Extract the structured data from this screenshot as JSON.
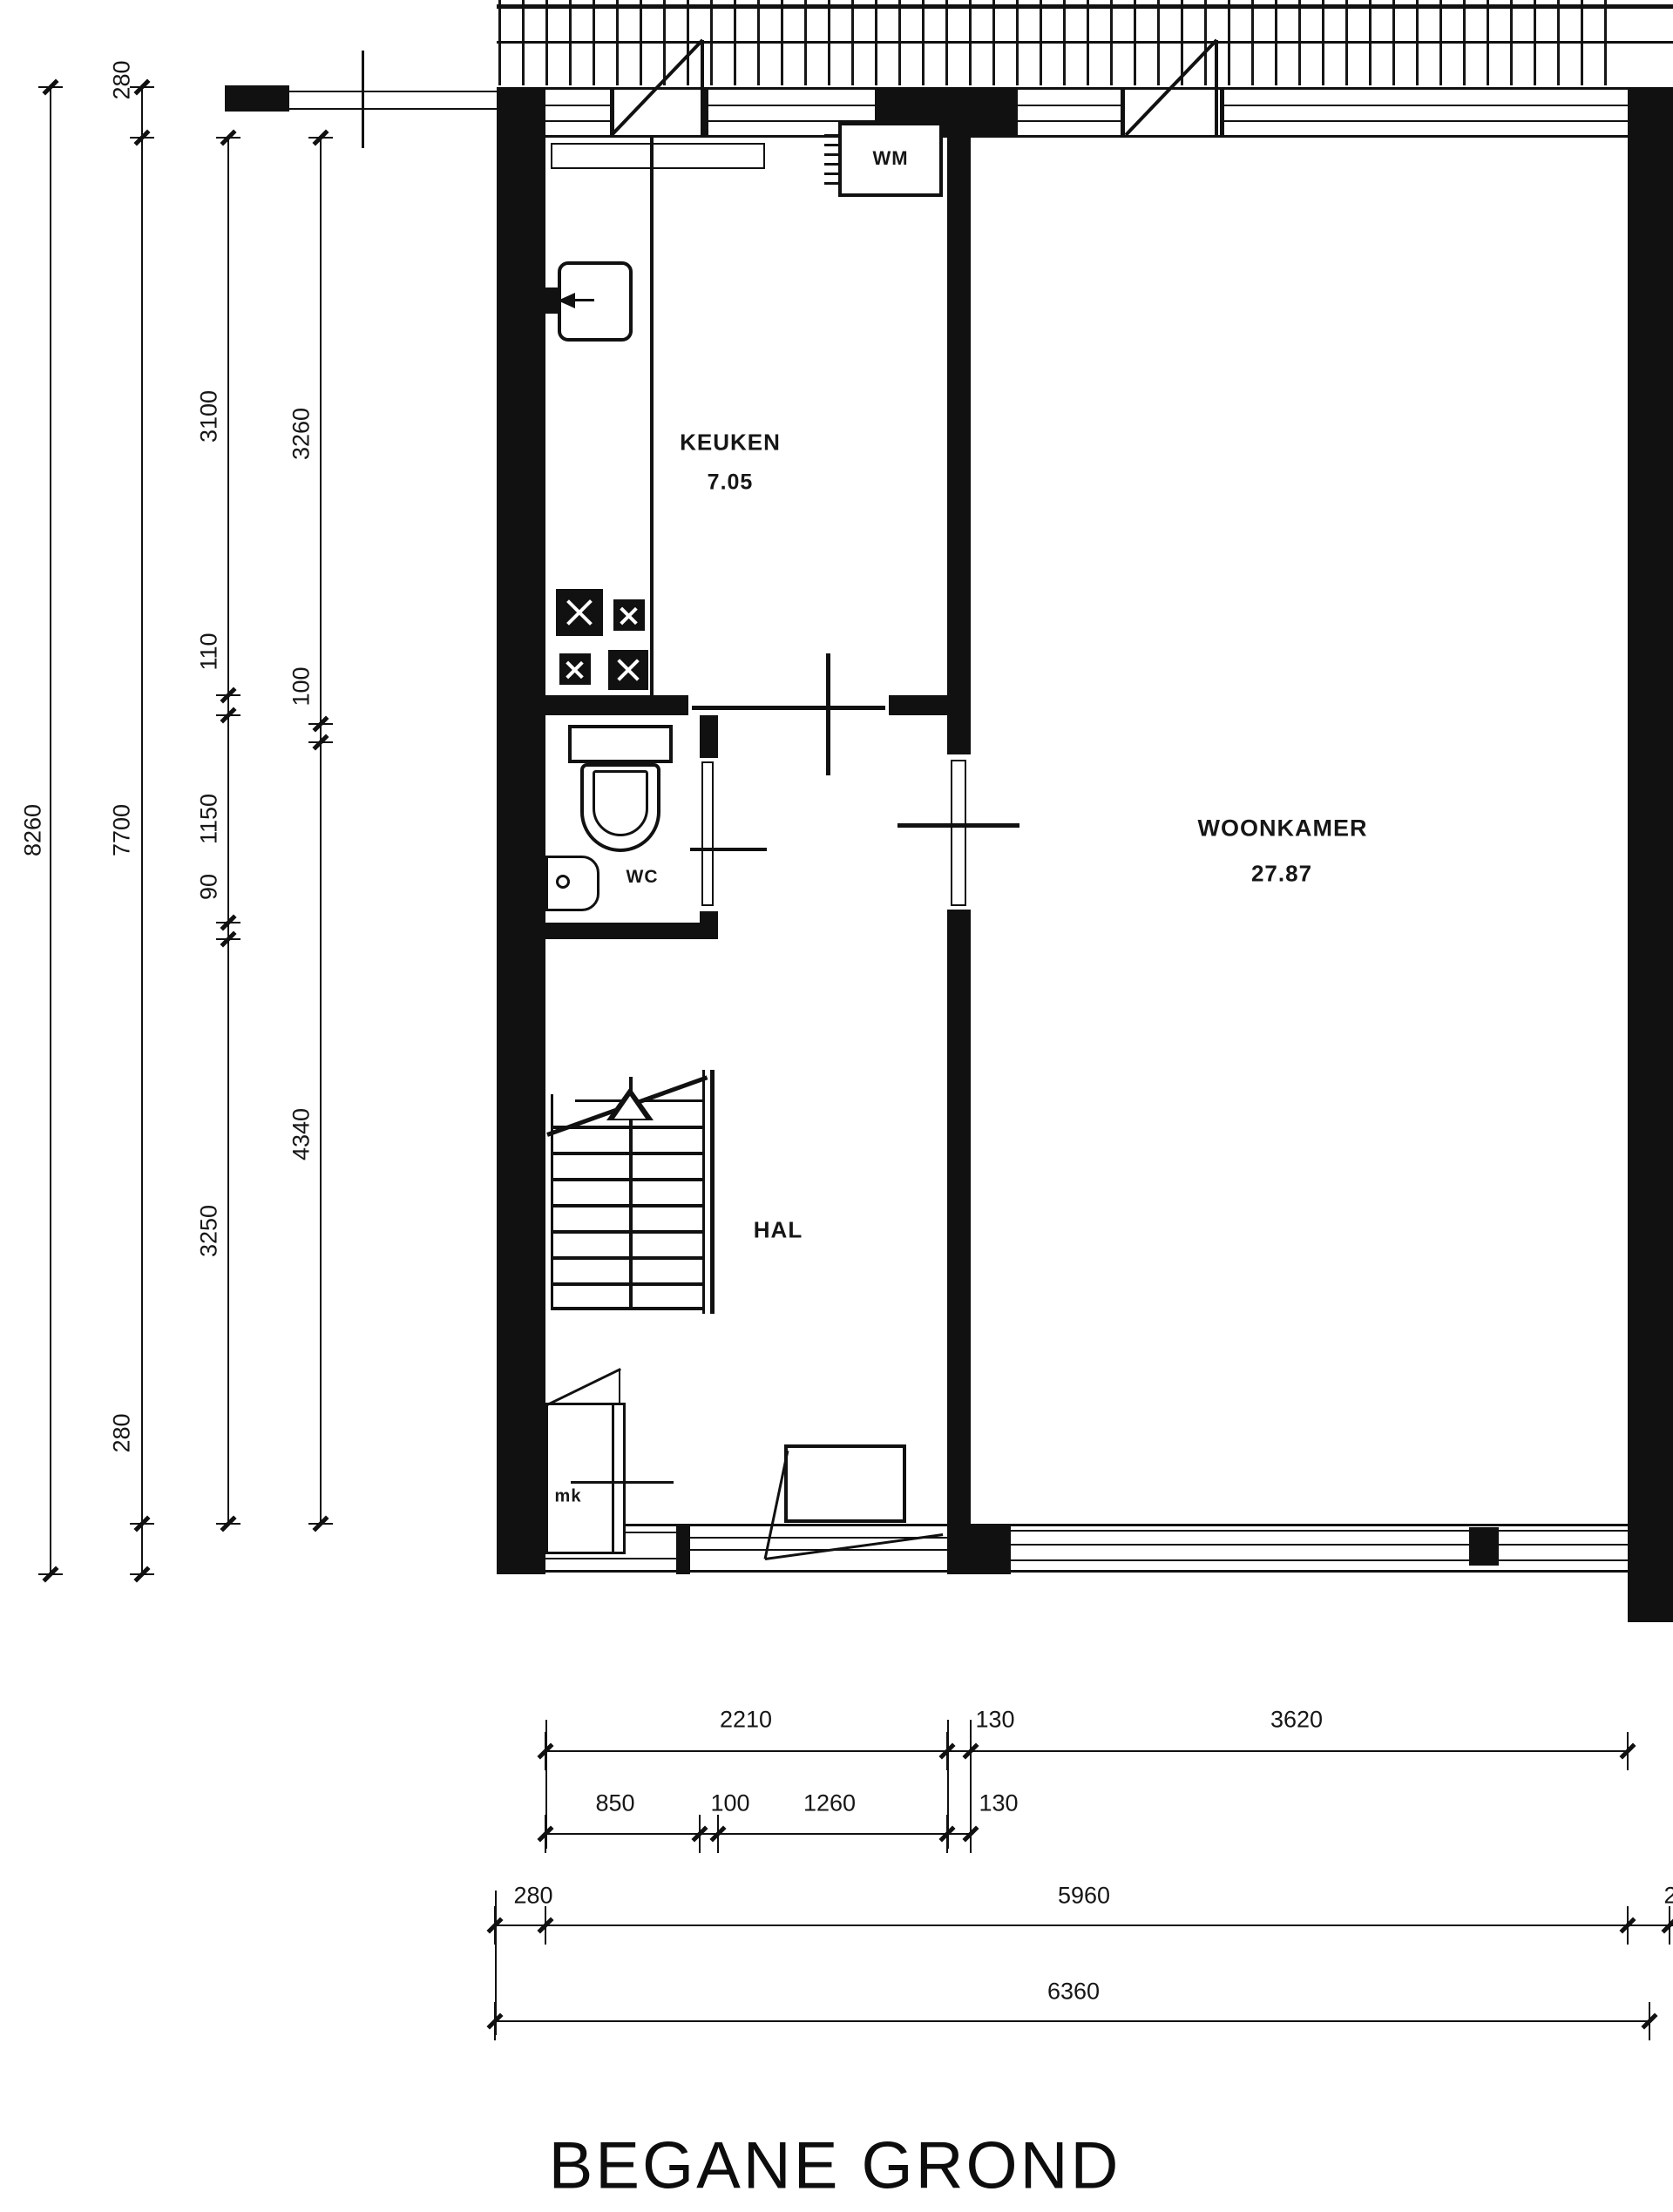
{
  "title": "BEGANE GROND",
  "drawing": {
    "ink_color": "#111111",
    "background_color": "#ffffff",
    "type": "floor-plan"
  },
  "rooms": {
    "keuken": {
      "label": "KEUKEN",
      "area": "7.05"
    },
    "woonkamer": {
      "label": "WOONKAMER",
      "area": "27.87"
    },
    "hal": {
      "label": "HAL"
    },
    "wc": {
      "label": "WC"
    },
    "wm": {
      "label": "WM"
    },
    "mk": {
      "label": "mk"
    }
  },
  "dimensions": {
    "left": {
      "col_a": [
        "8260"
      ],
      "col_b": [
        "280",
        "7700",
        "280"
      ],
      "col_c": [
        "3100",
        "110",
        "1150",
        "90",
        "3250"
      ],
      "col_d": [
        "3260",
        "100",
        "4340"
      ]
    },
    "bottom": {
      "row1": [
        "2210",
        "130",
        "3620"
      ],
      "row2": [
        "850",
        "100",
        "1260",
        "130"
      ],
      "row3": [
        "280",
        "5960",
        "2"
      ],
      "row4": [
        "6360"
      ]
    }
  }
}
